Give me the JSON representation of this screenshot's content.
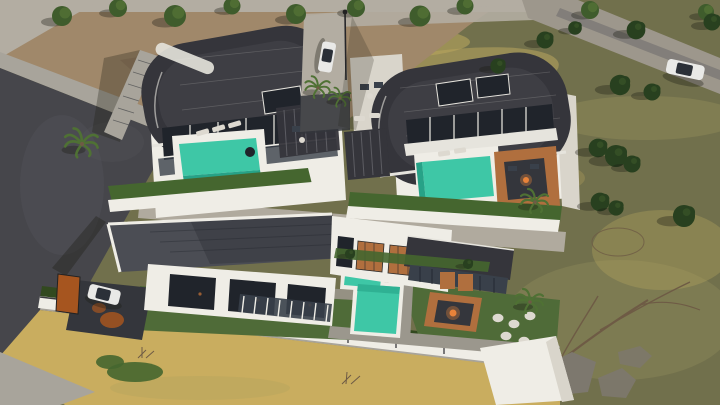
{
  "scene": {
    "type": "3d-architectural-aerial-render",
    "subject": "Aerial daytime render of a modern villa complex: two barrel-roof villas uphill and one large flat-roof villa downhill, each with a turquoise pool, terraces, pergolas and gardens, surrounded by dirt lot, streets and dry grass fields",
    "villas": [
      {
        "name": "upper-left-villa",
        "roof": "curved-barrel",
        "pool": "rectangular-infinity",
        "features": [
          "roof-skylight-stripe",
          "glass-balconies",
          "black-pergola",
          "sun-loungers",
          "hedge-terrace",
          "side-stairs"
        ]
      },
      {
        "name": "upper-right-villa",
        "roof": "curved-barrel",
        "pool": "rectangular-infinity",
        "features": [
          "glass-facade",
          "white-awnings",
          "wood-deck",
          "sunken-fire-lounge",
          "black-pergola"
        ]
      },
      {
        "name": "lower-villa",
        "roof": "flat-dark",
        "pool": "L-shaped",
        "features": [
          "white-upper-volume",
          "wood-door-panels",
          "glass-pavilion",
          "sunken-fire-pit-lounge",
          "pergola-slats",
          "driveway",
          "rust-gate",
          "pouf-seats",
          "perimeter-fence"
        ]
      }
    ],
    "vehicles": [
      {
        "name": "white-sedan-on-road",
        "location": "top-right road"
      },
      {
        "name": "white-car-upper-driveway",
        "location": "between upper villas"
      },
      {
        "name": "white-car-lower-driveway",
        "location": "lower villa driveway"
      }
    ],
    "landscape": [
      "top-road",
      "top-right-road",
      "dirt-lot",
      "cobble-sidewalk",
      "asphalt-street",
      "access-lane",
      "tree-row",
      "conifer-bushes",
      "dry-grass-field",
      "wheat-field",
      "palm-trees",
      "dead-tree",
      "rocks",
      "ground-cover-bush"
    ],
    "pool_count": 3,
    "lighting": "late-afternoon, sun from upper right, long shadows to lower left"
  },
  "colors": {
    "field": "#71704c",
    "fieldLight": "#8a8557",
    "dryGrass": "#b8a55e",
    "wheat": "#c9ad5f",
    "dirt": "#a0886a",
    "dirtShadow": "#8a7258",
    "roadLight": "#b3ada2",
    "roadMid": "#9d978c",
    "cobble": "#a8a49b",
    "asphalt": "#46464b",
    "asphaltLight": "#5a5a60",
    "wallWhite": "#efede6",
    "wallShade": "#d9d5cb",
    "roofDark": "#35353b",
    "roofMid": "#45454d",
    "roofTrim": "#e6e4dd",
    "flatRoof": "#4b4d54",
    "flatRoofShadow": "#34363c",
    "glass": "#20242b",
    "glassLight": "#39404a",
    "pool": "#3ec7a6",
    "poolDeep": "#27a287",
    "deckWood": "#b06f3e",
    "fire": "#e8833a",
    "hedge": "#45662f",
    "hedgeDark": "#32491f",
    "lawn": "#4f6b38",
    "treeGreen": "#3f5c2c",
    "treeLight": "#5d7c3a",
    "conifer": "#28401f",
    "palmGreen": "#4f7134",
    "stone": "#9b978d",
    "fenceRail": "#3a3a3e",
    "carWhite": "#e9e9e7",
    "carGlass": "#2b3038",
    "gate": "#a6551f",
    "deadWood": "#6e5b45",
    "rock": "#7d786e",
    "pouf": "#ddd9d0",
    "shadow": "rgba(30,30,20,0.35)"
  }
}
